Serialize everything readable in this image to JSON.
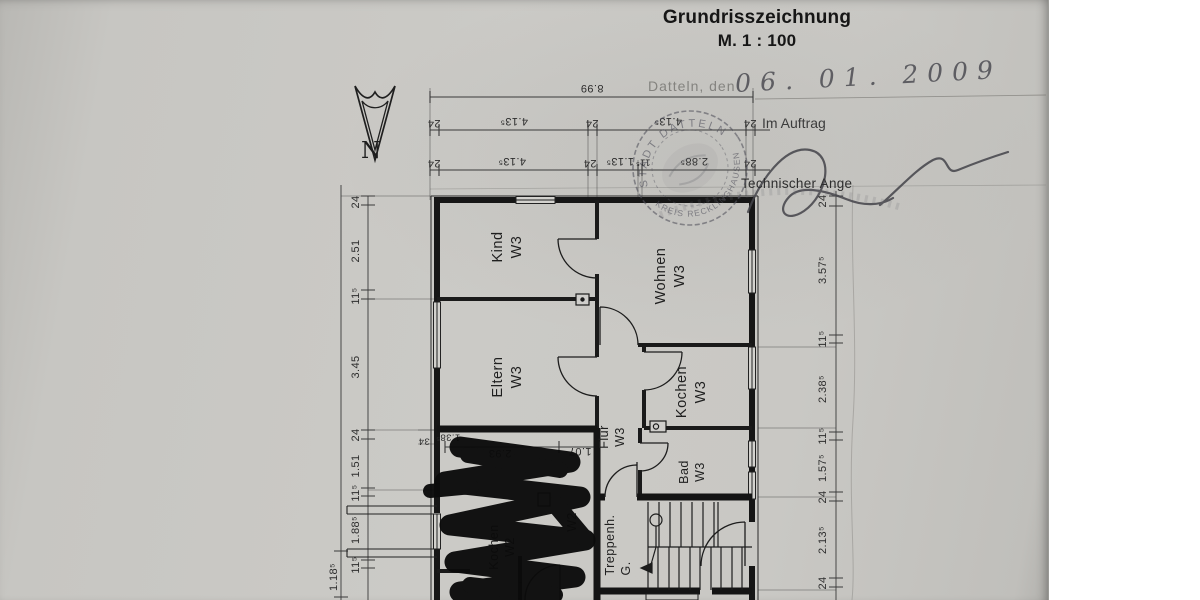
{
  "document": {
    "title_line1": "Grundrisszeichnung",
    "title_line2": "M. 1 : 100",
    "date_label": "Datteln, den",
    "date_value": "06. 01. 2009",
    "order_label": "Im Auftrag",
    "signer_role": "Technischer Ange",
    "north_letter": "N"
  },
  "stamp": {
    "arc_top": "STADT DATTELN",
    "arc_bottom": "KREIS RECKLINGHAUSEN"
  },
  "dimensions": {
    "top_overall": "8.99",
    "top_row2": [
      "24",
      "4.13⁵",
      "24",
      "4.13⁵",
      "24"
    ],
    "top_row3": [
      "24",
      "4.13⁵",
      "24",
      "1.13⁵",
      "11⁵",
      "2.88⁵",
      "24"
    ],
    "left": [
      "24",
      "2.51",
      "11⁵",
      "3.45",
      "24",
      "1.51",
      "11⁵",
      "1.88⁵",
      "11⁵"
    ],
    "left_outer": "1.18⁵",
    "right": [
      "24",
      "3.57⁵",
      "11⁵",
      "2.38⁵",
      "11⁵",
      "1.57⁵",
      "24",
      "2.13⁵",
      "24"
    ],
    "inner": [
      "1.38⁵",
      "34",
      "2.93",
      "1.07"
    ]
  },
  "rooms": [
    {
      "name": "Kind",
      "unit": "W3"
    },
    {
      "name": "Wohnen",
      "unit": "W3"
    },
    {
      "name": "Eltern",
      "unit": "W3"
    },
    {
      "name": "Kochen",
      "unit": "W3"
    },
    {
      "name": "Flur",
      "unit": "W3"
    },
    {
      "name": "Bad",
      "unit": "W3"
    },
    {
      "name": "Kochen",
      "unit": "W2"
    },
    {
      "name": "Treppenh.",
      "unit": "G."
    }
  ],
  "colors": {
    "paper": "#c9c8c4",
    "ink": "#1a1a1a",
    "stamp": "#53535f",
    "redaction": "#0b0b0b"
  }
}
